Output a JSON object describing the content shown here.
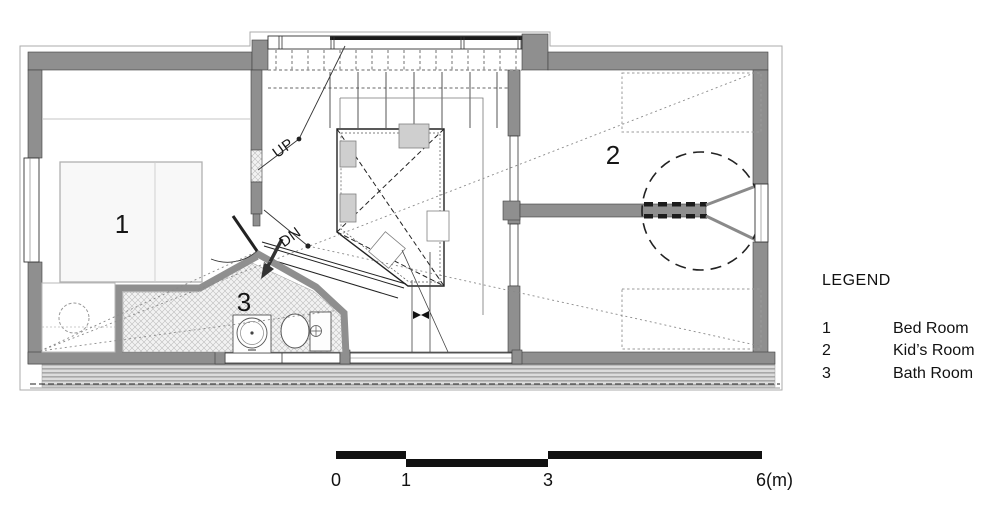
{
  "plan": {
    "room_labels": {
      "bedroom": "1",
      "kids_room": "2",
      "bath_room": "3"
    },
    "stairs": {
      "up": "UP",
      "dn": "DN"
    }
  },
  "legend": {
    "title": "LEGEND",
    "entries": [
      {
        "num": "1",
        "label": "Bed Room"
      },
      {
        "num": "2",
        "label": "Kid’s Room"
      },
      {
        "num": "3",
        "label": "Bath Room"
      }
    ]
  },
  "scale_bar": {
    "labels": [
      "0",
      "1",
      "3",
      "6(m)"
    ]
  },
  "colors": {
    "wall": "#8f8f8f",
    "line": "#222222",
    "band": "#d9d9d9",
    "hatch": "#bdbdbd",
    "text": "#111111"
  }
}
